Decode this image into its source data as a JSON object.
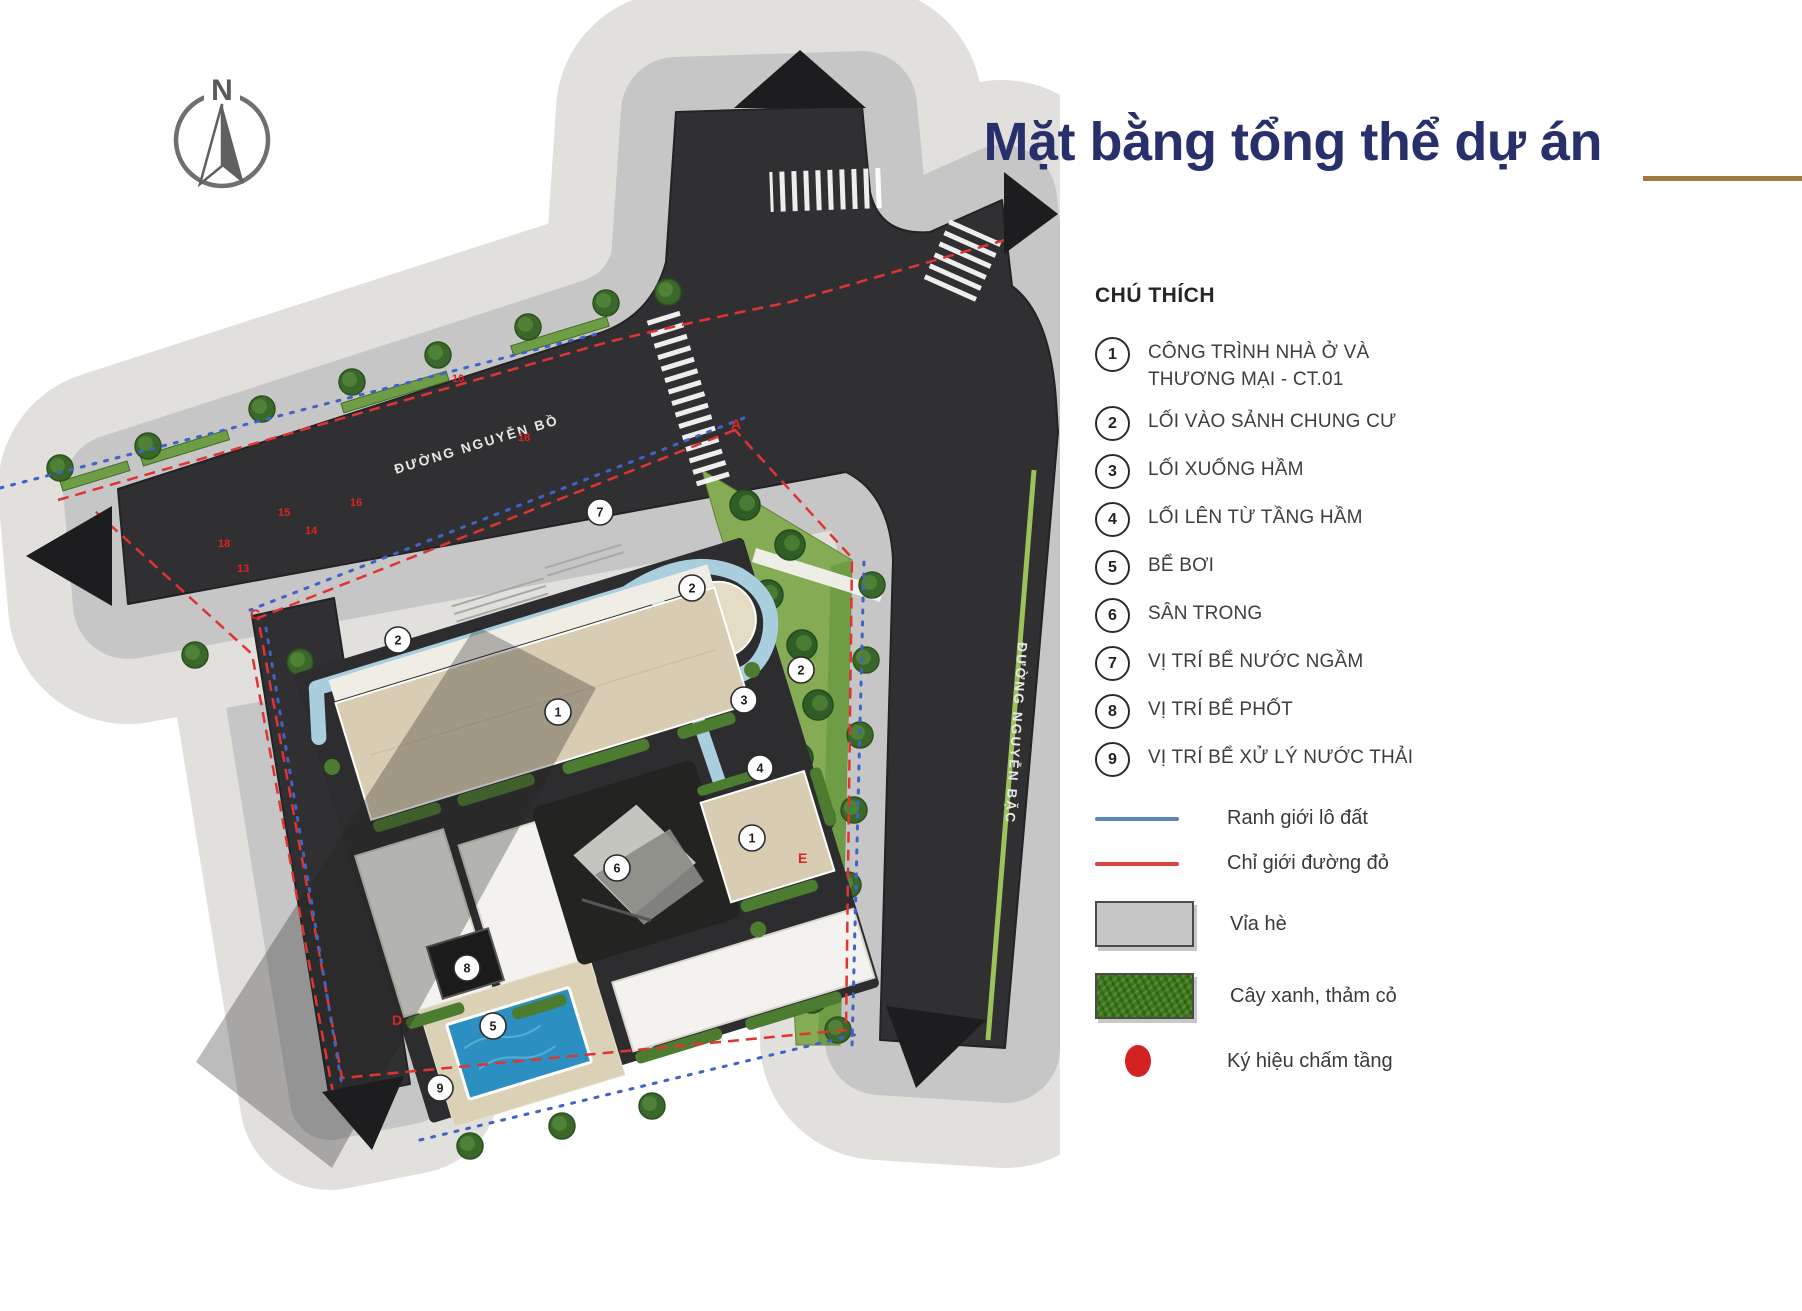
{
  "title": {
    "text": "Mặt bằng tổng thể dự án"
  },
  "compass": {
    "label": "N"
  },
  "site_plan": {
    "streets": {
      "horizontal": "ĐƯỜNG NGUYỄN BỒ",
      "vertical": "ĐƯỜNG NGUYỄN BẶC"
    },
    "markers": [
      "1",
      "2",
      "2",
      "2",
      "3",
      "4",
      "5",
      "6",
      "7",
      "8",
      "9",
      "1"
    ],
    "corner_labels": [
      "A",
      "C",
      "D",
      "E"
    ],
    "survey_points": [
      "10",
      "18",
      "15",
      "16",
      "14",
      "18",
      "13"
    ]
  },
  "legend": {
    "title": "CHÚ THÍCH",
    "items": [
      {
        "number": "1",
        "label": "CÔNG TRÌNH NHÀ Ở VÀ\nTHƯƠNG MẠI - CT.01"
      },
      {
        "number": "2",
        "label": "LỐI VÀO SẢNH CHUNG CƯ"
      },
      {
        "number": "3",
        "label": "LỐI XUỐNG HẦM"
      },
      {
        "number": "4",
        "label": "LỐI LÊN TỪ TẦNG HẦM"
      },
      {
        "number": "5",
        "label": "BỂ BƠI"
      },
      {
        "number": "6",
        "label": "SÂN TRONG"
      },
      {
        "number": "7",
        "label": "VỊ TRÍ BỂ NƯỚC NGẦM"
      },
      {
        "number": "8",
        "label": "VỊ TRÍ BỂ PHỐT"
      },
      {
        "number": "9",
        "label": "VỊ TRÍ BỂ XỬ LÝ NƯỚC THẢI"
      }
    ],
    "symbols": [
      {
        "type": "line-blue",
        "label": "Ranh giới lô đất",
        "color": "#5d87b8"
      },
      {
        "type": "line-red",
        "label": "Chỉ giới đường đỏ",
        "color": "#d84543"
      },
      {
        "type": "swatch-gray",
        "label": "Vỉa hè",
        "color": "#c6c6c6"
      },
      {
        "type": "swatch-green",
        "label": "Cây xanh, thảm cỏ",
        "color": "#3e7a1f"
      },
      {
        "type": "dot-red",
        "label": "Ký hiệu chấm tầng",
        "color": "#d42121"
      }
    ]
  },
  "colors": {
    "title_navy": "#27306b",
    "rule_brown": "#a07a3e",
    "legend_text": "#3d3d3d",
    "boundary_blue": "#3f63c6",
    "boundary_red": "#e03434",
    "legend_line_blue": "#5d87b8",
    "legend_line_red": "#d84543",
    "road": "#303032",
    "sidewalk": "#c6c6c6",
    "sidewalk_mottled": "#e2e0dd",
    "green_strip": "#6f9d45",
    "lawn": "#85ac55",
    "median": "#9cc25c",
    "water": "#a9cfdf",
    "pool": "#2c8fc2",
    "roof_tan": "#d8cdb2",
    "roof_white": "#f3f2ee",
    "podium": "#2d2d2f",
    "marker_red_dot": "#d42121",
    "swatch_gray": "#c6c6c6",
    "swatch_green": "#3e7a1f"
  }
}
